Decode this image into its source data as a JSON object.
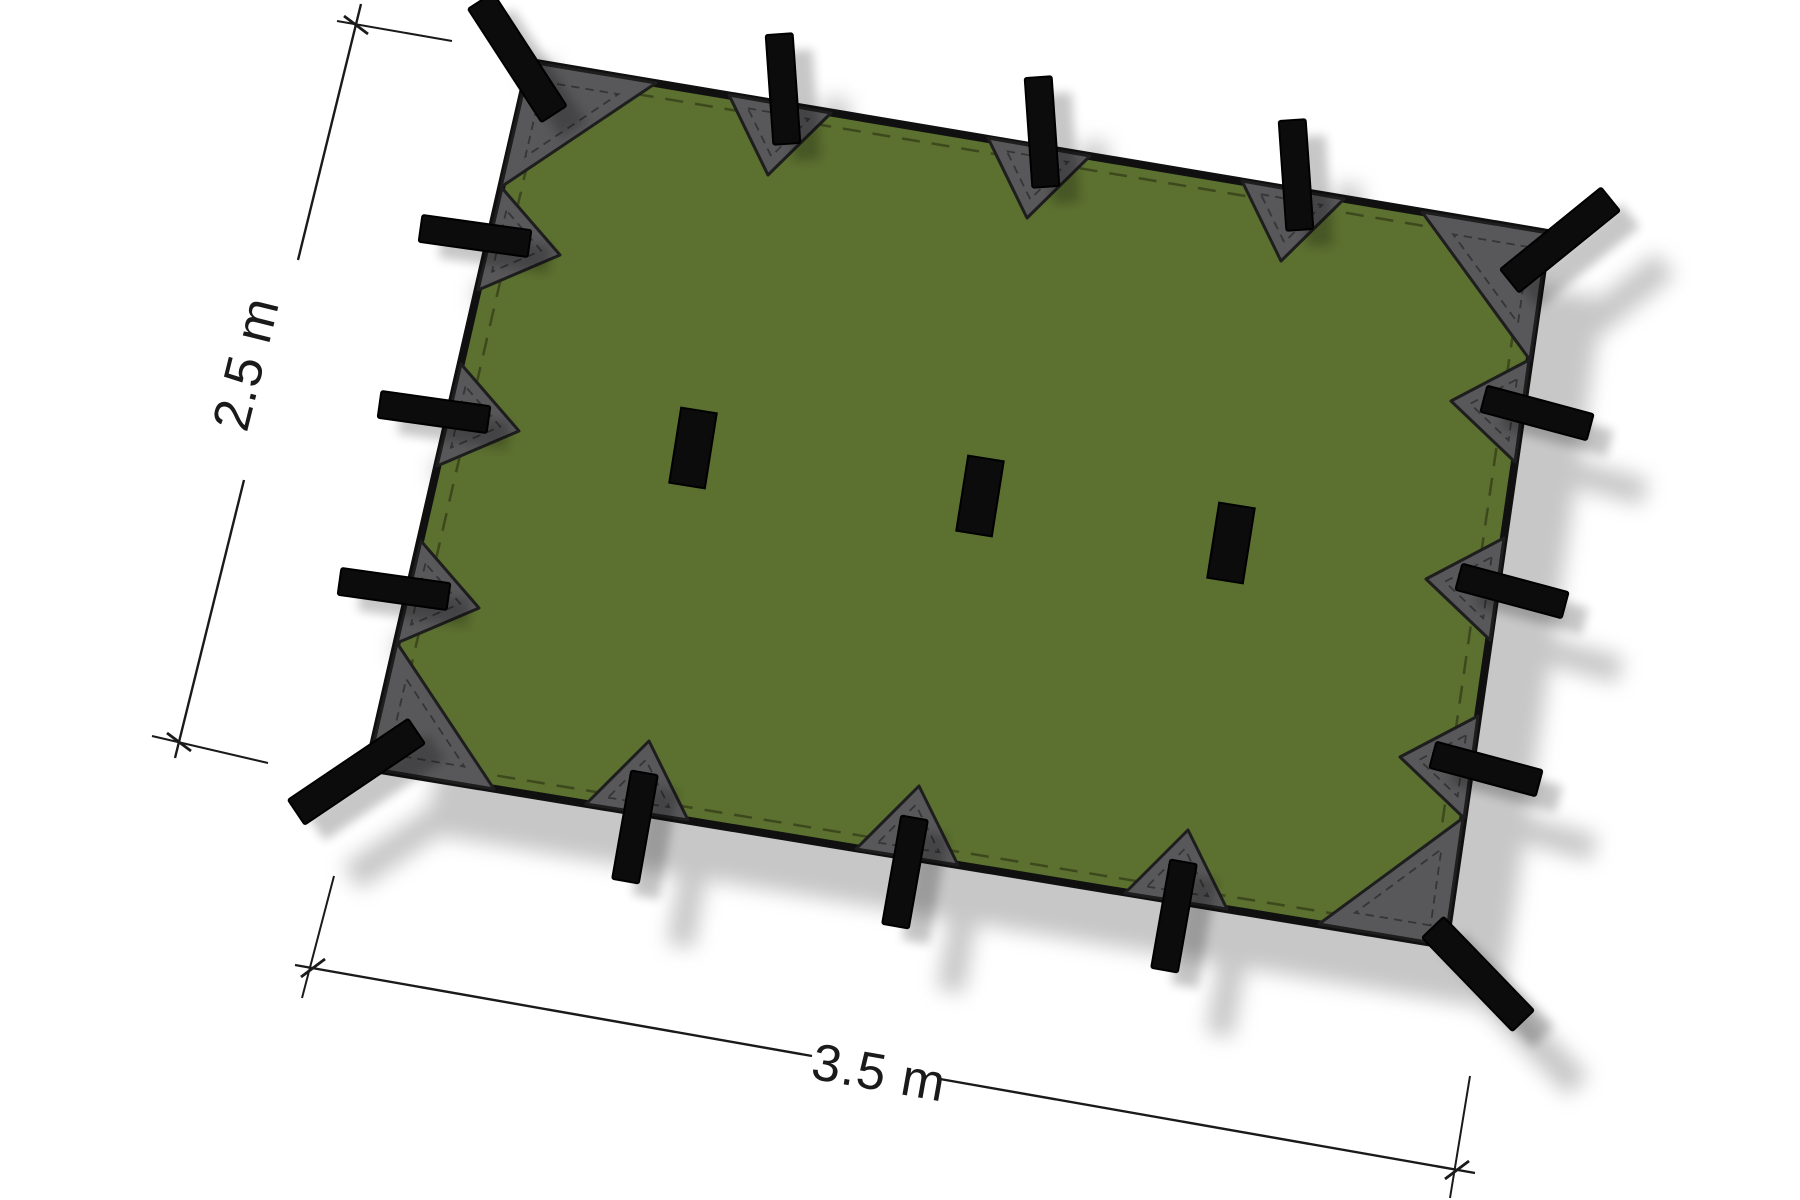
{
  "diagram": {
    "subject": "rectangular-tarp-top-view",
    "width_label": "3.5 m",
    "height_label": "2.5 m",
    "attachment_loops": {
      "corner": 4,
      "edge": 12,
      "center": 3,
      "total": 19
    }
  },
  "colors": {
    "background": "#ffffff",
    "tarp_green": "#5c7030",
    "tarp_outline": "#101010",
    "seam_stitch": "#3d491d",
    "patch_gray": "#58585a",
    "patch_border": "#1e1e1e",
    "strap_black": "#0c0c0c",
    "shadow_gray": "#8f8f8f",
    "dimension": "#1a1a1a"
  }
}
